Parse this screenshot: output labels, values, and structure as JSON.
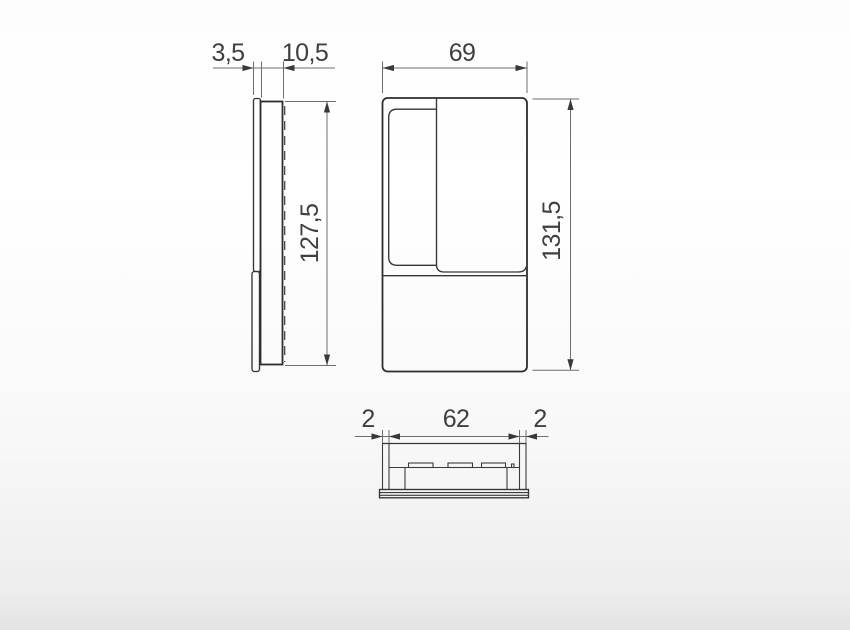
{
  "dimensions": {
    "side": {
      "plate_thickness": "3,5",
      "body_depth": "10,5",
      "body_height": "127,5"
    },
    "front": {
      "width": "69",
      "height": "131,5"
    },
    "bottom": {
      "edge_left": "2",
      "inner_width": "62",
      "edge_right": "2"
    }
  },
  "colors": {
    "part_outline": "#2d2d2d",
    "detail_line": "#353535",
    "dimension_line": "#6e6e6e",
    "dimension_text": "#3f3f3f",
    "background_top": "#fdfdfd",
    "background_bottom": "#e3e3e3"
  }
}
